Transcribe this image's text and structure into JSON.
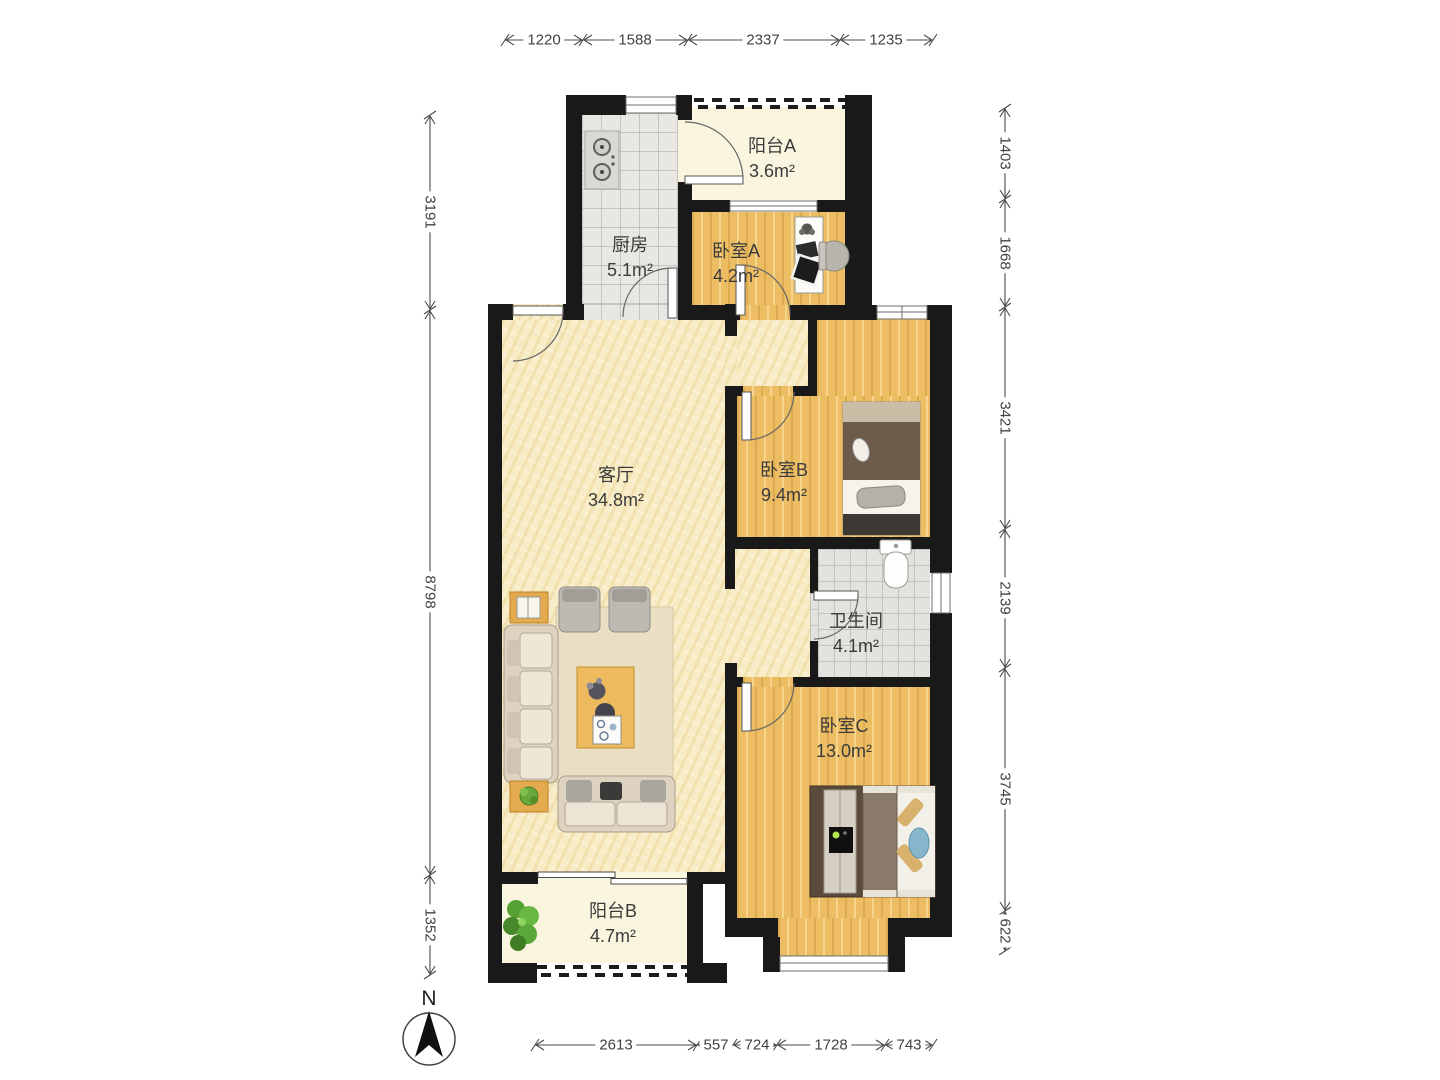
{
  "compass": {
    "label": "N"
  },
  "rooms": [
    {
      "id": "balcony-a",
      "name": "阳台A",
      "area": "3.6m²"
    },
    {
      "id": "kitchen",
      "name": "厨房",
      "area": "5.1m²"
    },
    {
      "id": "bedroom-a",
      "name": "卧室A",
      "area": "4.2m²"
    },
    {
      "id": "living-room",
      "name": "客厅",
      "area": "34.8m²"
    },
    {
      "id": "bedroom-b",
      "name": "卧室B",
      "area": "9.4m²"
    },
    {
      "id": "bathroom",
      "name": "卫生间",
      "area": "4.1m²"
    },
    {
      "id": "bedroom-c",
      "name": "卧室C",
      "area": "13.0m²"
    },
    {
      "id": "balcony-b",
      "name": "阳台B",
      "area": "4.7m²"
    }
  ],
  "dimensions": {
    "top": [
      "1220",
      "1588",
      "2337",
      "1235"
    ],
    "left": [
      "3191",
      "8798",
      "1352"
    ],
    "right": [
      "1403",
      "1668",
      "3421",
      "2139",
      "3745",
      "622"
    ],
    "bottom": [
      "2613",
      "557",
      "724",
      "1728",
      "743"
    ]
  },
  "colors": {
    "wall": "#191919",
    "wood": "#ecbd63",
    "cream": "#f7ecc6",
    "tile": "#e8e7e3",
    "ivory": "#faf5df",
    "dim_text": "#414141"
  }
}
